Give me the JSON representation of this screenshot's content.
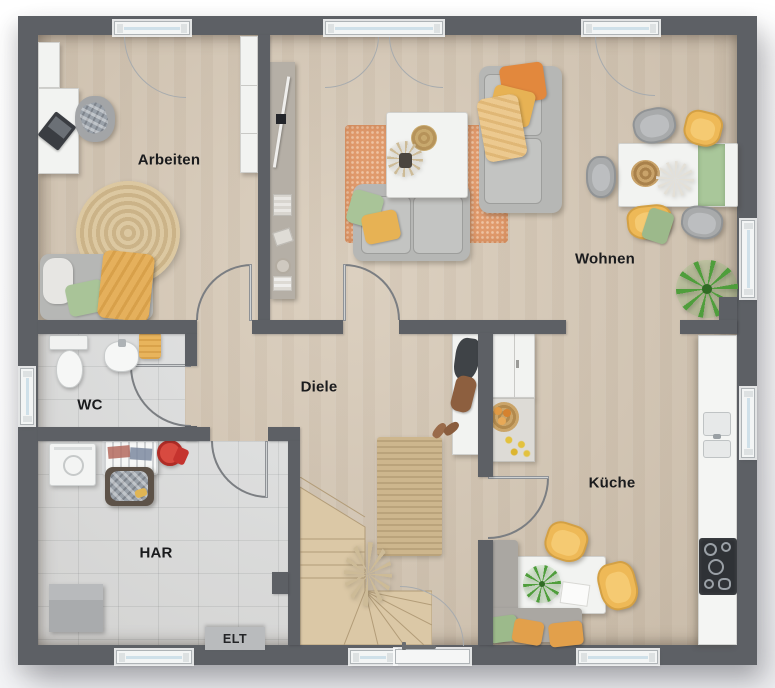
{
  "plan": {
    "type": "residential-floor-plan-top-view",
    "rooms": {
      "arbeiten": {
        "label": "Arbeiten"
      },
      "wohnen": {
        "label": "Wohnen"
      },
      "diele": {
        "label": "Diele"
      },
      "wc": {
        "label": "WC"
      },
      "har": {
        "label": "HAR"
      },
      "kueche": {
        "label": "Küche"
      },
      "elt": {
        "label": "ELT"
      }
    },
    "palette": {
      "wall": "#5d6065",
      "wood_floor": "#d8cbb9",
      "tile_floor": "#e1e3e4",
      "stair_wood": "#dbc8a6",
      "rug_orange": "#e09a6c",
      "jute": "#cdb68d",
      "sofa_gray": "#b6b7b5",
      "accent_mustard": "#eeb957",
      "accent_sage": "#a9c498",
      "accent_orange": "#e2883d",
      "plant_green": "#4f9e3c",
      "window_glass": "#cfe0e9",
      "red_accent": "#c5332e"
    },
    "counts": {
      "windows": 8,
      "entrance_doors": 1,
      "interior_door_swings": 5
    }
  }
}
